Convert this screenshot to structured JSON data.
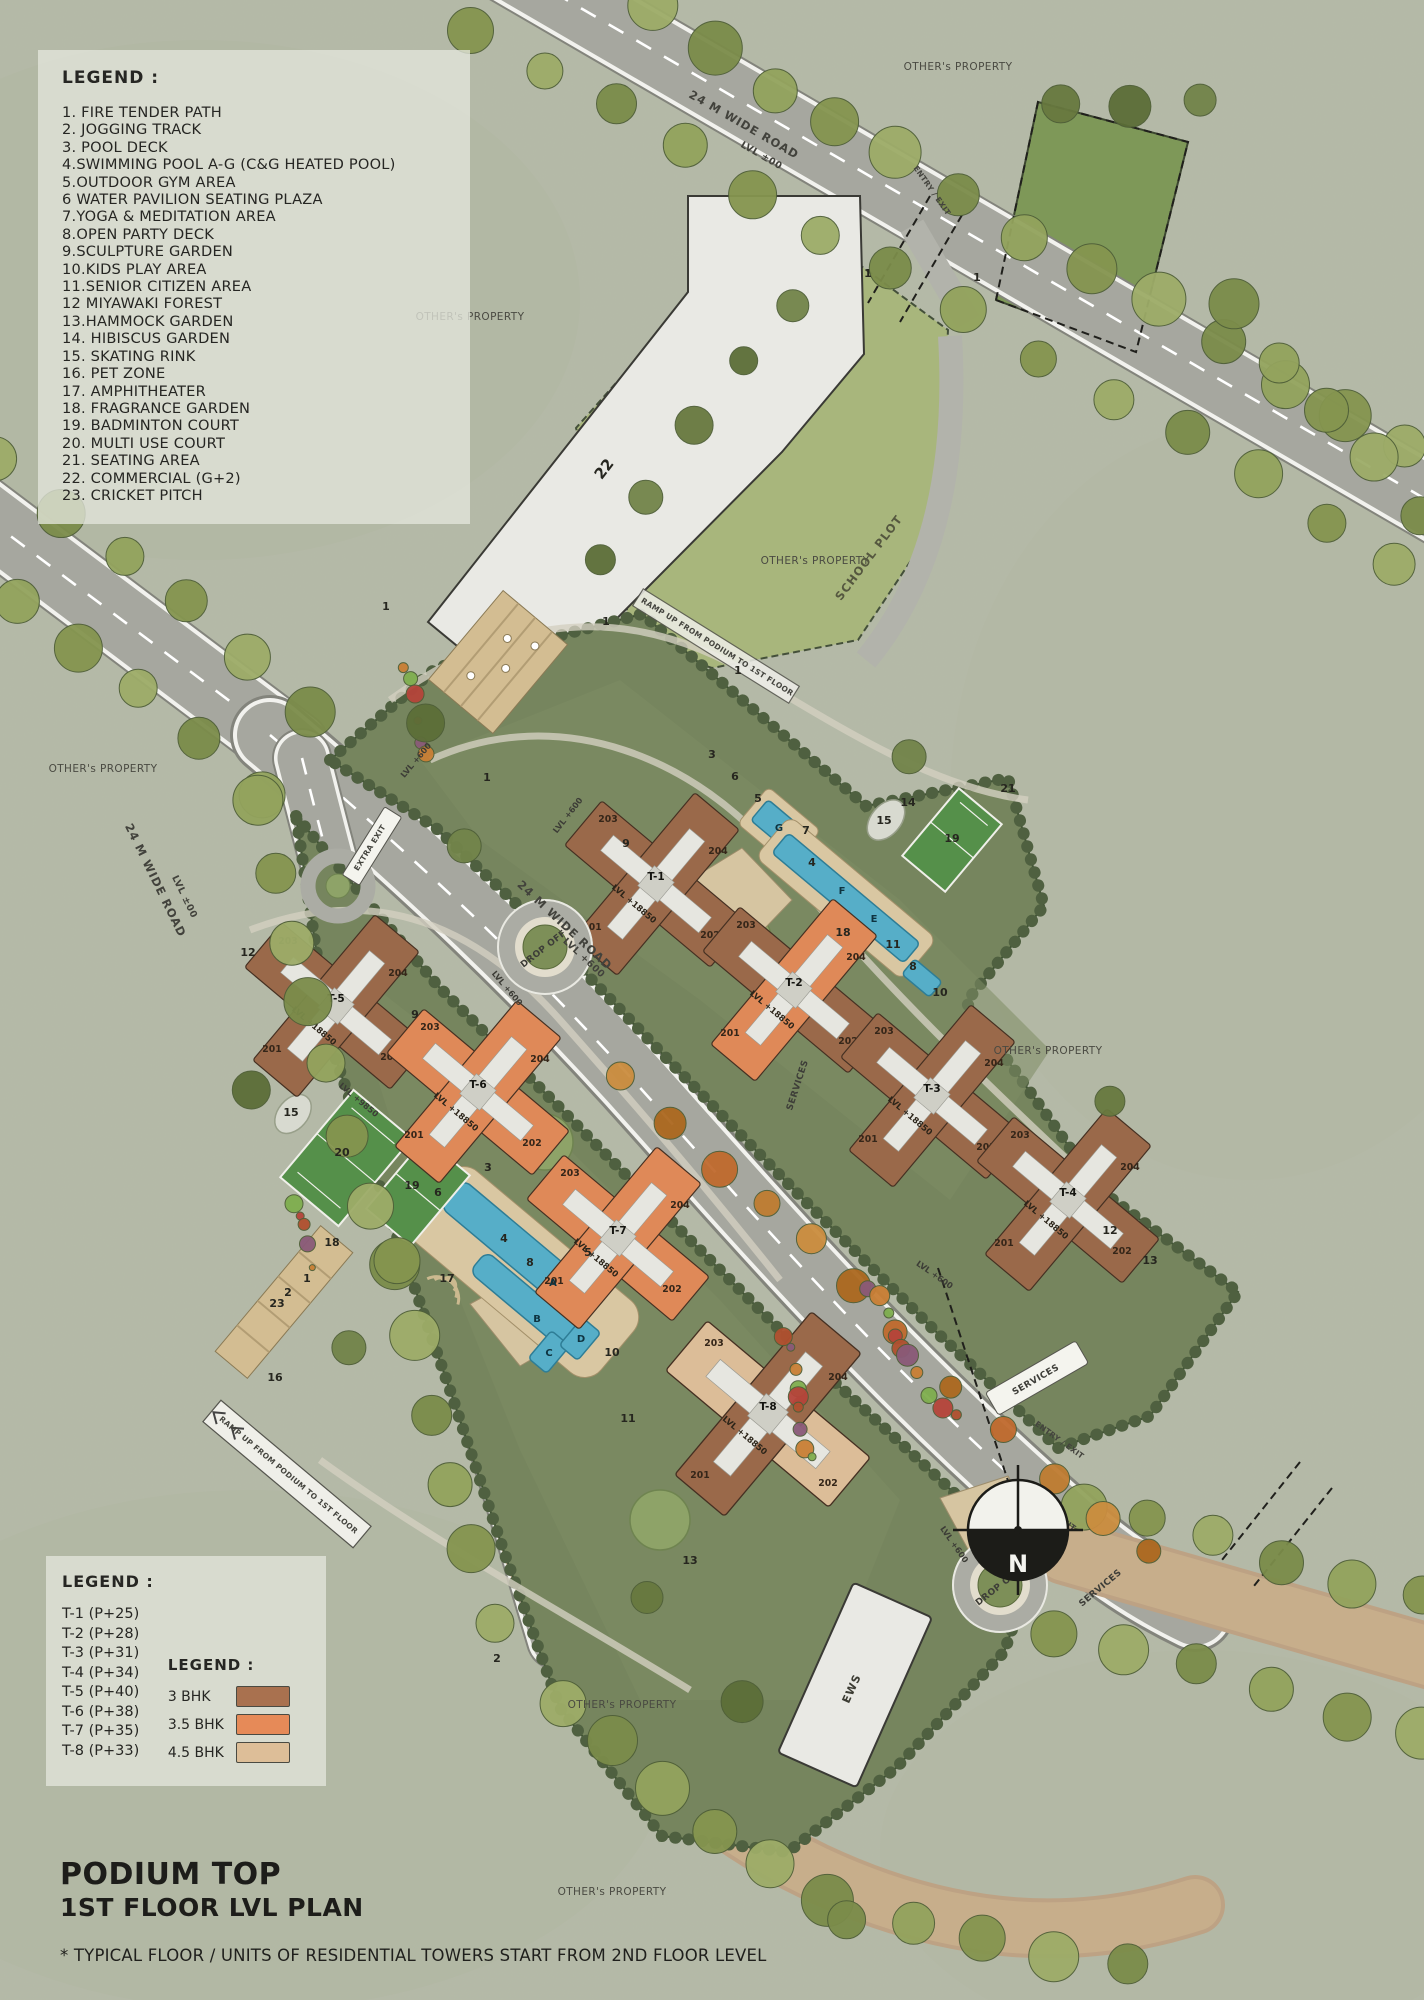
{
  "legend_amenities": {
    "title": "LEGEND :",
    "items": [
      "1. FIRE TENDER PATH",
      "2. JOGGING TRACK",
      "3. POOL DECK",
      "4.SWIMMING POOL A-G (C&G HEATED POOL)",
      "5.OUTDOOR GYM AREA",
      "6 WATER PAVILION SEATING PLAZA",
      "7.YOGA & MEDITATION AREA",
      "8.OPEN PARTY DECK",
      "9.SCULPTURE GARDEN",
      "10.KIDS PLAY AREA",
      "11.SENIOR CITIZEN AREA",
      "12 MIYAWAKI FOREST",
      "13.HAMMOCK GARDEN",
      "14. HIBISCUS GARDEN",
      "15. SKATING RINK",
      "16. PET ZONE",
      "17. AMPHITHEATER",
      "18. FRAGRANCE GARDEN",
      "19. BADMINTON COURT",
      "20. MULTI USE COURT",
      "21. SEATING AREA",
      "22. COMMERCIAL (G+2)",
      "23. CRICKET PITCH"
    ]
  },
  "legend_towers": {
    "title": "LEGEND :",
    "items": [
      "T-1 (P+25)",
      "T-2 (P+28)",
      "T-3 (P+31)",
      "T-4 (P+34)",
      "T-5 (P+40)",
      "T-6 (P+38)",
      "T-7 (P+35)",
      "T-8 (P+33)"
    ]
  },
  "legend_units": {
    "title": "LEGEND :",
    "items": [
      {
        "label": "3 BHK",
        "color": "#a9714f"
      },
      {
        "label": "3.5 BHK",
        "color": "#e68a58"
      },
      {
        "label": "4.5 BHK",
        "color": "#ddbe98"
      }
    ]
  },
  "title_block": {
    "line1": "PODIUM TOP",
    "line2": "1ST FLOOR LVL PLAN",
    "footnote": "* TYPICAL FLOOR / UNITS OF RESIDENTIAL TOWERS START FROM 2ND FLOOR LEVEL"
  },
  "site": {
    "others_property": "OTHER's PROPERTY",
    "school_plot": "SCHOOL PLOT",
    "road_name": "24 M WIDE ROAD",
    "lvl00": "LVL ±00",
    "lvl600": "LVL +600",
    "lvl_podium": "LVL +18850",
    "lvl_court": "LVL +9850",
    "entry_exit": "ENTRY / EXIT",
    "extra_exit": "EXTRA EXIT",
    "ramp": "RAMP UP FROM PODIUM TO 1ST FLOOR",
    "drop_off": "DROP OFF",
    "services": "SERVICES",
    "ews": "EWS"
  },
  "towers": {
    "t1": "T-1",
    "t2": "T-2",
    "t3": "T-3",
    "t4": "T-4",
    "t5": "T-5",
    "t6": "T-6",
    "t7": "T-7",
    "t8": "T-8",
    "units": {
      "u201": "201",
      "u202": "202",
      "u203": "203",
      "u204": "204"
    }
  },
  "pools": {
    "a": "A",
    "b": "B",
    "c": "C",
    "d": "D",
    "e": "E",
    "f": "F",
    "g": "G"
  },
  "markers": {
    "m1": "1",
    "m2": "2",
    "m3": "3",
    "m4": "4",
    "m5": "5",
    "m6": "6",
    "m7": "7",
    "m8": "8",
    "m9": "9",
    "m10": "10",
    "m11": "11",
    "m12": "12",
    "m13": "13",
    "m14": "14",
    "m15": "15",
    "m16": "16",
    "m17": "17",
    "m18": "18",
    "m19": "19",
    "m20": "20",
    "m21": "21",
    "m22": "22",
    "m23": "23"
  },
  "compass": {
    "n": "N"
  }
}
